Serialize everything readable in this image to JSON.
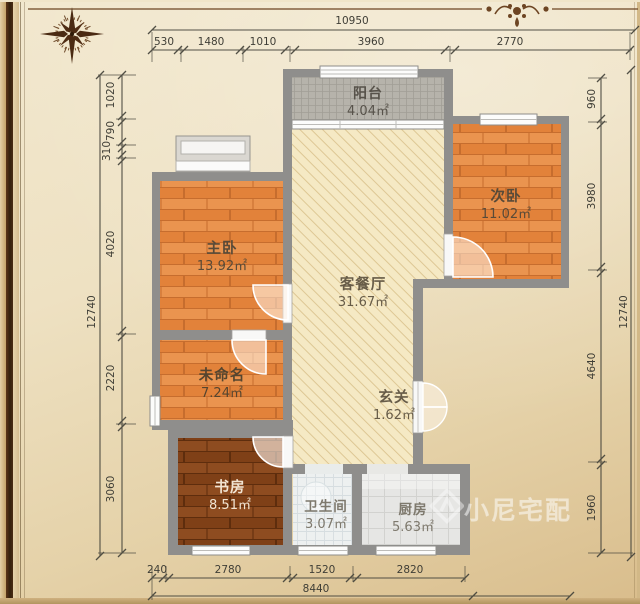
{
  "rooms": [
    {
      "name": "阳台",
      "area": "4.04㎡"
    },
    {
      "name": "次卧",
      "area": "11.02㎡"
    },
    {
      "name": "主卧",
      "area": "13.92㎡"
    },
    {
      "name": "客餐厅",
      "area": "31.67㎡"
    },
    {
      "name": "未命名",
      "area": "7.24㎡"
    },
    {
      "name": "玄关",
      "area": "1.62㎡"
    },
    {
      "name": "书房",
      "area": "8.51㎡"
    },
    {
      "name": "卫生间",
      "area": "3.07㎡"
    },
    {
      "name": "厨房",
      "area": "5.63㎡"
    }
  ],
  "dimensions": {
    "top": {
      "total": "10950",
      "segments": [
        "530",
        "1480",
        "1010",
        "3960",
        "2770"
      ]
    },
    "bottom": {
      "total": "8440",
      "segments": [
        "240",
        "2780",
        "1520",
        "2820"
      ]
    },
    "left": {
      "total": "12740",
      "segments": [
        "1020",
        "790",
        "310",
        "4020",
        "2220",
        "3060"
      ]
    },
    "right": {
      "total": "12740",
      "segments": [
        "960",
        "3980",
        "4640",
        "1960"
      ]
    }
  },
  "watermark": {
    "text": "小尼宅配"
  },
  "colors": {
    "wall": "#8f8e8c",
    "wood_floor": "#e8914c",
    "dark_wood_floor": "#8c4a1f",
    "living_floor": "#f5e9c4",
    "balcony_tile": "#b6b3ab",
    "bath_tile": "#edf0f0",
    "kitchen_tile": "#e6e6e4",
    "paper": "#ecdfbd",
    "ornament_brown": "#6d4523"
  }
}
